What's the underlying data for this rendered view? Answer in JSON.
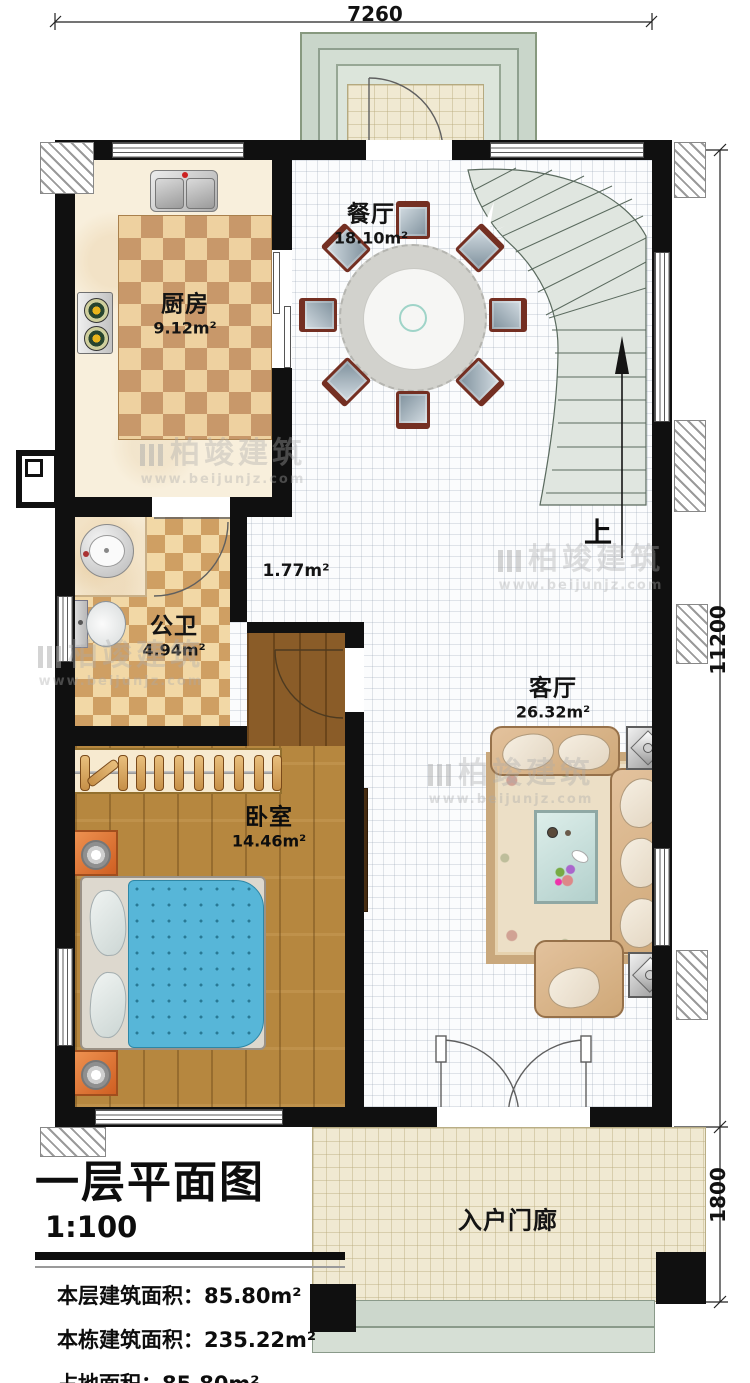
{
  "dimensions": {
    "top": "7260",
    "right_upper": "11200",
    "right_lower": "1800"
  },
  "rooms": {
    "dining": {
      "name": "餐厅",
      "area": "18.10m²"
    },
    "kitchen": {
      "name": "厨房",
      "area": "9.12m²"
    },
    "bathroom": {
      "name": "公卫",
      "area": "4.94m²"
    },
    "hallway": {
      "area": "1.77m²"
    },
    "living": {
      "name": "客厅",
      "area": "26.32m²"
    },
    "bedroom": {
      "name": "卧室",
      "area": "14.46m²"
    },
    "porch": {
      "name": "入户门廊"
    }
  },
  "stairs": {
    "direction_label": "上"
  },
  "title_block": {
    "title": "一层平面图",
    "scale": "1:100",
    "rows": [
      {
        "label": "本层建筑面积：",
        "value": "85.80m²"
      },
      {
        "label": "本栋建筑面积：",
        "value": "235.22m²"
      },
      {
        "label": "占地面积：",
        "value": "85.80m²"
      },
      {
        "label": "层高：",
        "value": "3.6m"
      }
    ]
  },
  "watermark": {
    "brand": "柏竣建筑",
    "url": "www.beijunjz.com"
  },
  "colors": {
    "wall": "#101010",
    "wood": "#b6873f",
    "tile_light": "#eed1a0",
    "tile_dark": "#c8986a",
    "stair": "#e0e6e0",
    "quilt": "#57b6d8",
    "porch_tile": "#f0e9d2"
  }
}
